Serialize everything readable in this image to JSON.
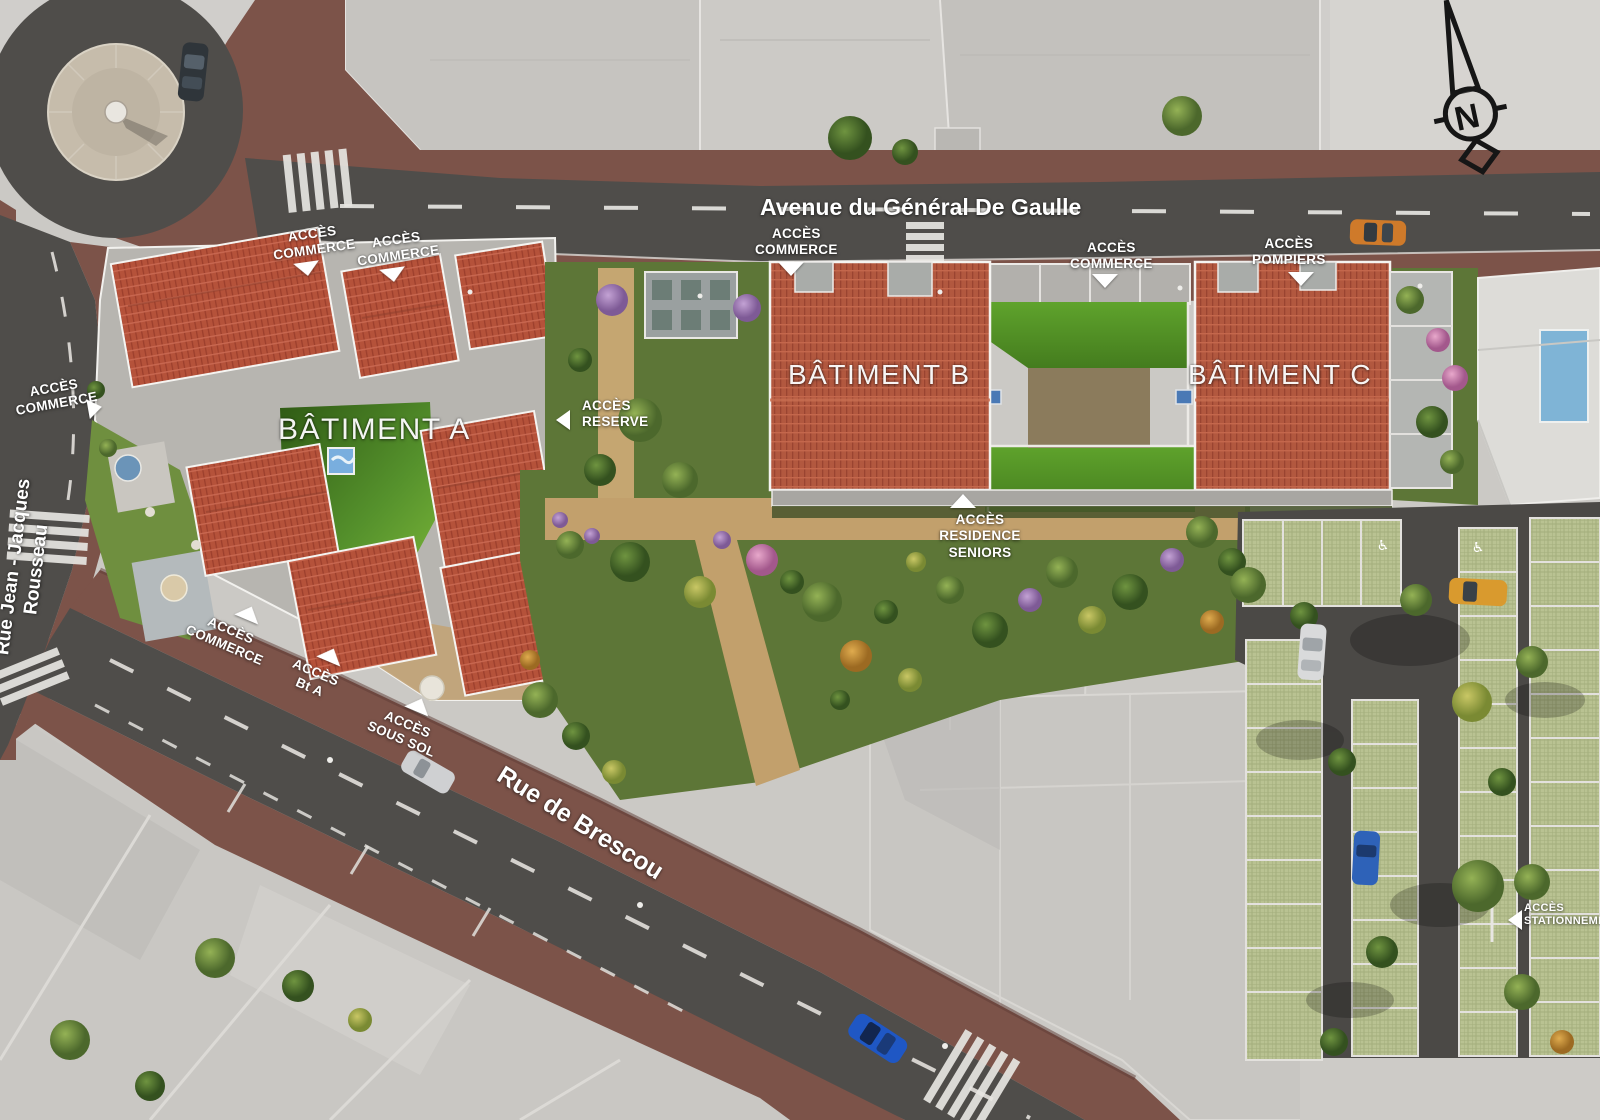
{
  "plan": {
    "streets": {
      "avenue": "Avenue du Général De Gaulle",
      "rue_rousseau": "Rue Jean - Jacques Rousseau",
      "rue_brescou": "Rue de Brescou"
    },
    "buildings": {
      "a": "BÂTIMENT A",
      "b": "BÂTIMENT B",
      "c": "BÂTIMENT C"
    },
    "access": {
      "commerce_nw1": "ACCÈS\nCOMMERCE",
      "commerce_nw2": "ACCÈS\nCOMMERCE",
      "commerce_b": "ACCÈS\nCOMMERCE",
      "commerce_c": "ACCÈS\nCOMMERCE",
      "pompiers": "ACCÈS\nPOMPIERS",
      "commerce_west": "ACCÈS\nCOMMERCE",
      "reserve": "ACCÈS\nRESERVE",
      "residence_seniors": "ACCÈS\nRESIDENCE\nSENIORS",
      "commerce_south": "ACCÈS\nCOMMERCE",
      "bt_a": "ACCÈS\nBt A",
      "sous_sol": "ACCÈS\nSOUS SOL",
      "stationnement": "ACCÈS\nSTATIONNEMENT",
      "handicap_symbol": "♿"
    },
    "compass": {
      "north": "N"
    },
    "colors": {
      "road": "#4f4d4a",
      "sidewalk": "#7c5349",
      "roof_tiles": "#b2583f",
      "lawn": "#55912c",
      "parking_stall": "#b9c292",
      "label_text": "#ffffff"
    }
  }
}
